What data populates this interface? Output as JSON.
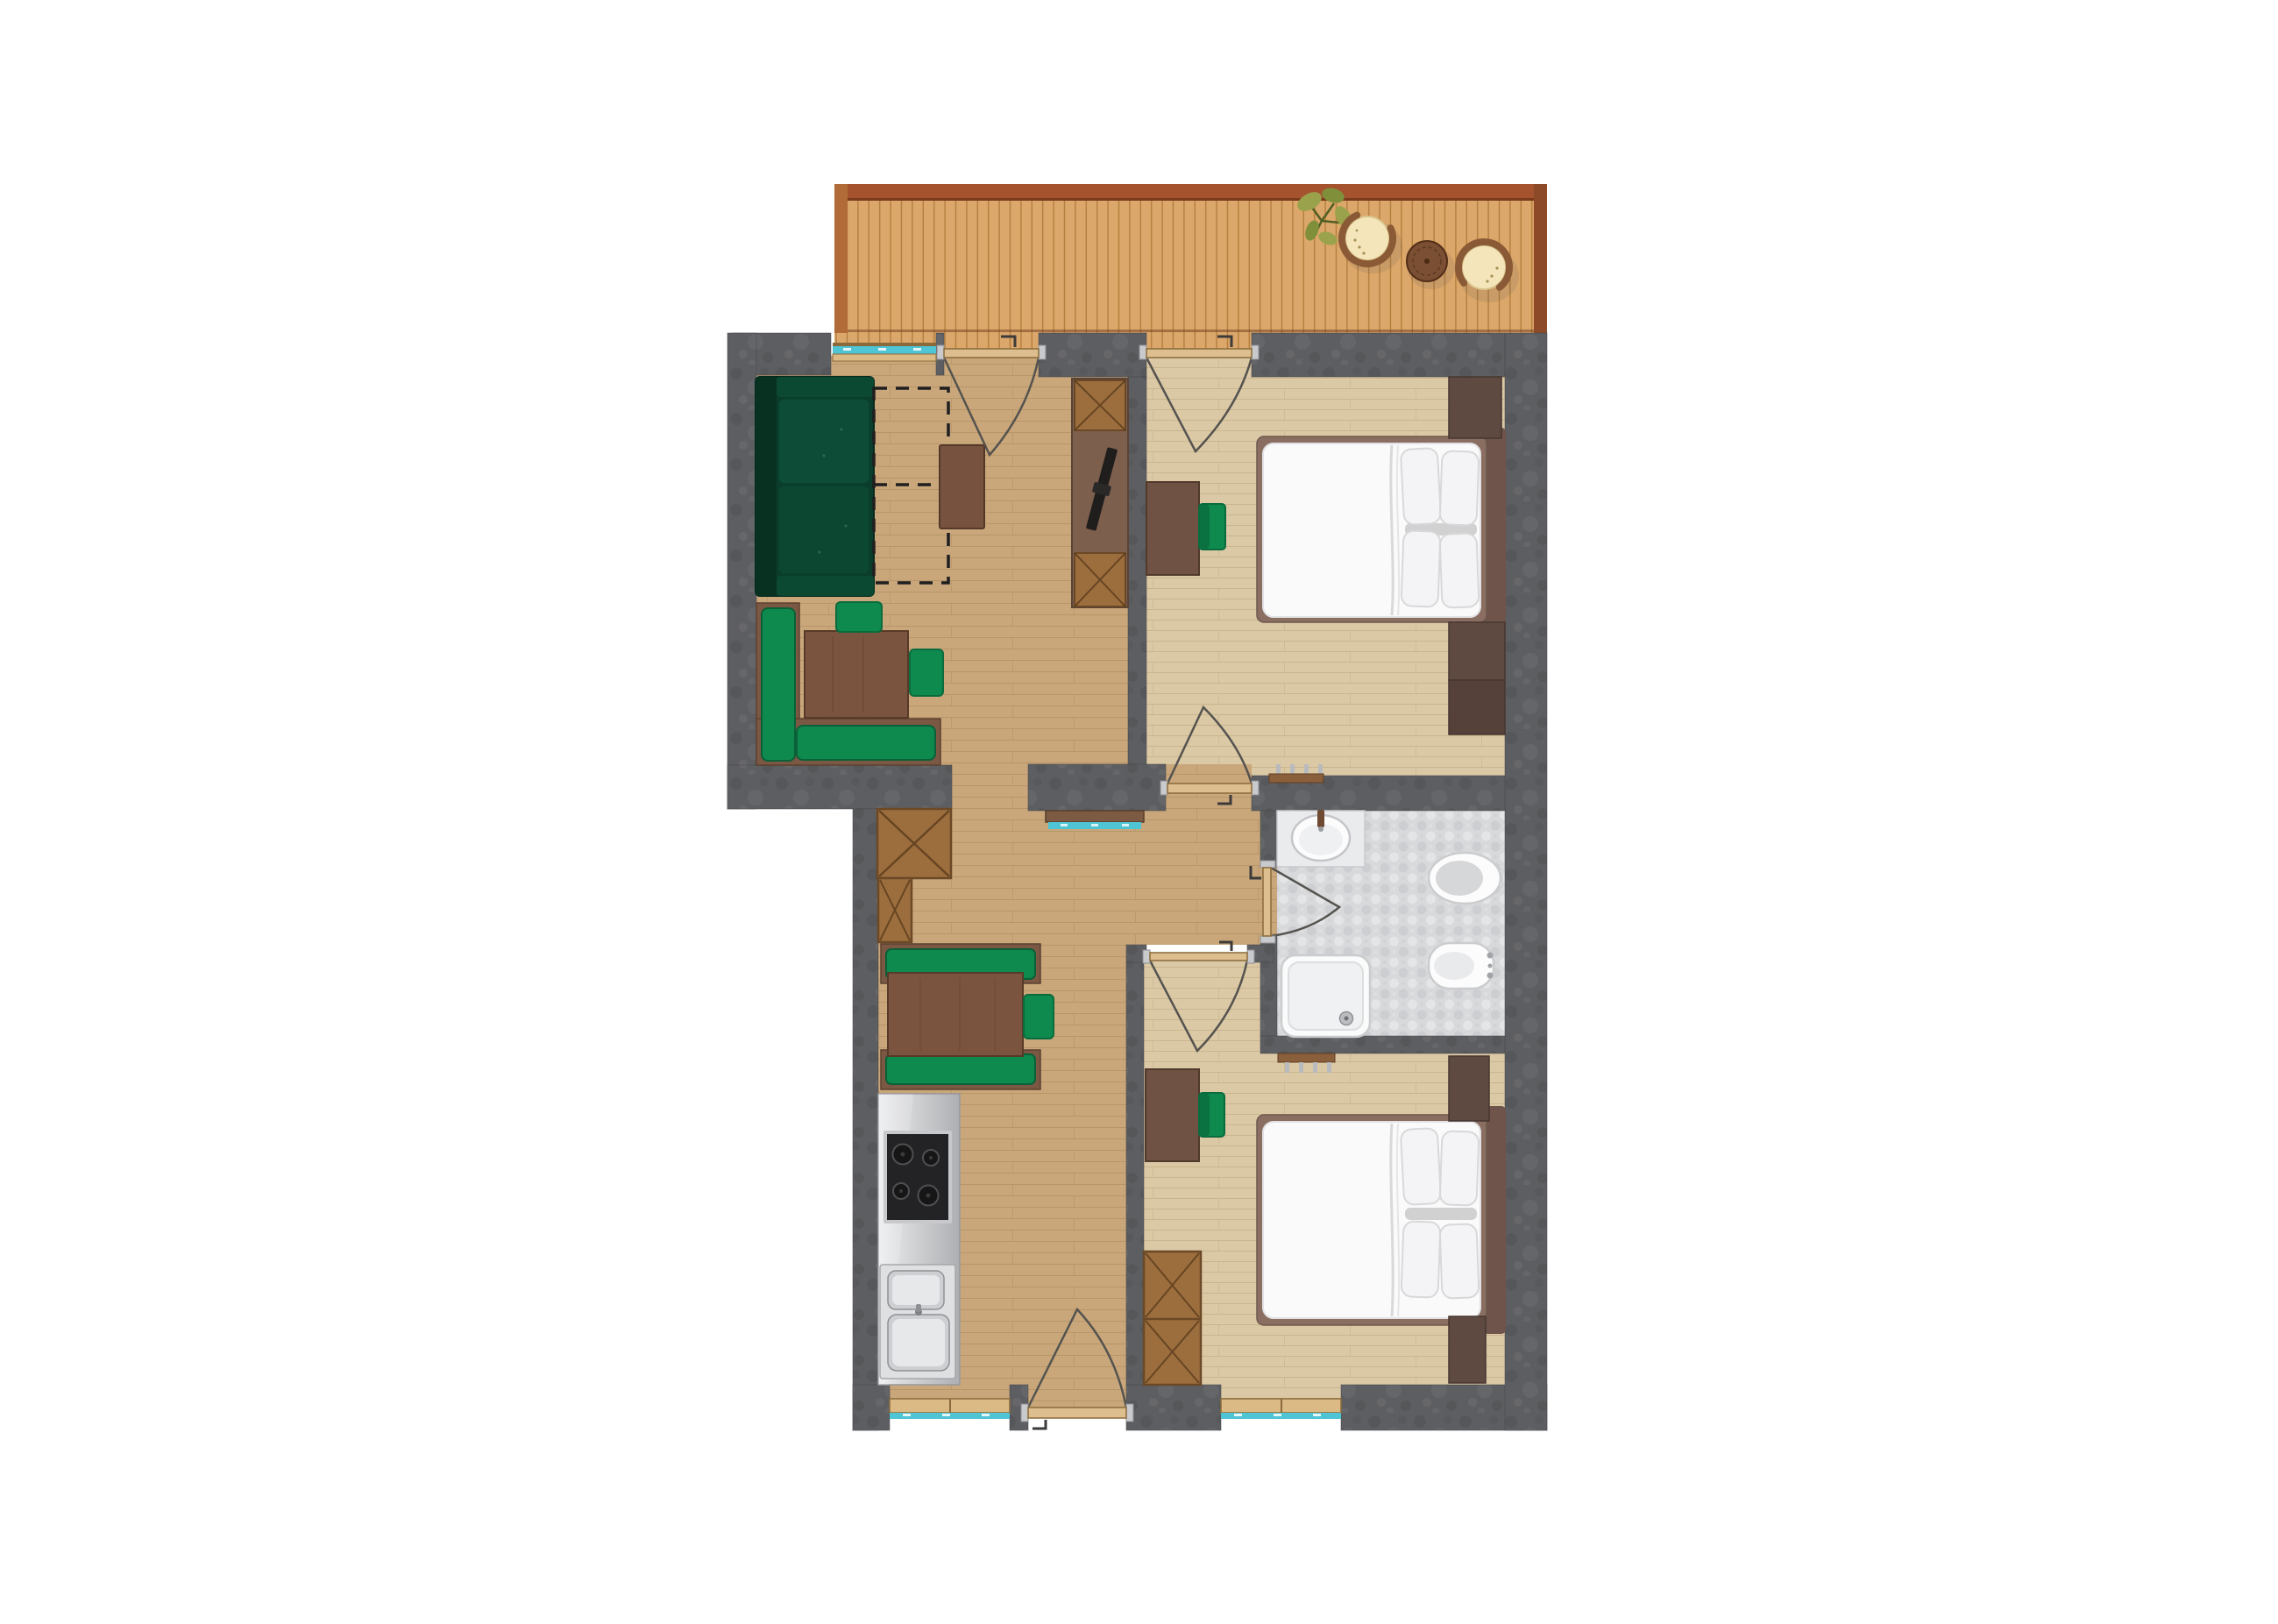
{
  "plan": {
    "type": "apartment-floor-plan",
    "rooms": [
      {
        "name": "terrace"
      },
      {
        "name": "living-dining-area"
      },
      {
        "name": "hallway"
      },
      {
        "name": "kitchen"
      },
      {
        "name": "bedroom-1"
      },
      {
        "name": "bathroom"
      },
      {
        "name": "bedroom-2"
      }
    ],
    "doors": [
      {
        "name": "balcony-door-living"
      },
      {
        "name": "balcony-door-bedroom-1"
      },
      {
        "name": "door-bedroom-1"
      },
      {
        "name": "door-bedroom-2"
      },
      {
        "name": "door-bathroom"
      },
      {
        "name": "entry-door"
      }
    ],
    "windows": [
      {
        "name": "living-room-window"
      },
      {
        "name": "kitchen-window"
      },
      {
        "name": "bedroom-2-window"
      }
    ],
    "furniture": {
      "terrace": [
        "plant",
        "rattan-lounge-chair",
        "round-side-table",
        "rattan-lounge-chair"
      ],
      "living_dining": [
        "corner-sofa",
        "sofa-bed-extension-outline",
        "coffee-table",
        "corner-bench",
        "dining-table",
        "dining-chair",
        "dining-chair",
        "tv-sideboard",
        "tv",
        "wardrobe-cabinet",
        "wardrobe-cabinet",
        "console-shelf"
      ],
      "kitchen": [
        "kitchen-counter",
        "cooktop",
        "double-sink",
        "booth-bench",
        "booth-bench",
        "dining-table",
        "dining-chair"
      ],
      "bedroom_1": [
        "desk",
        "desk-chair",
        "double-bed",
        "nightstand",
        "dresser",
        "radiator"
      ],
      "bathroom": [
        "vanity-sink",
        "toilet",
        "bidet",
        "shower"
      ],
      "bedroom_2": [
        "desk",
        "desk-chair",
        "wardrobe",
        "double-bed",
        "nightstand",
        "nightstand",
        "radiator"
      ]
    }
  },
  "colors": {
    "bg": "#ffffff",
    "wall": "#5d5e61",
    "wallEdge": "#45464a",
    "deck": "#dca76a",
    "deckLine": "#a5702f",
    "railTop": "#a4532e",
    "railLeft": "#b06b38",
    "railRight": "#8c4a28",
    "deckEdge": "#6b3c1e",
    "floorHall": "#c9a77a",
    "floorHallLine": "#a8885c",
    "floorBed": "#dbc9a6",
    "floorBedLine": "#bda87d",
    "tileBase": "#d8d9db",
    "tileDark": "#c9cacd",
    "tileLight": "#e4e5e7",
    "teal": "#4fc4d5",
    "sillTan": "#dcba86",
    "frameBrown": "#8a6a3a",
    "doorLeaf": "#ddbe8e",
    "arcStroke": "#55534f",
    "hingeGray": "#c9cacd",
    "handleDark": "#3c3b39",
    "furnBrown": "#7b5844",
    "tableBrown": "#7b5440",
    "tableEdge": "#573a28",
    "deskBrown": "#6f5243",
    "deskEdge": "#51392b",
    "cabWood": "#9c6e3e",
    "cabEdge": "#6b4826",
    "cabCross": "#5b3c1c",
    "tvBoard": "#7d5f4e",
    "tvBlack": "#201e1c",
    "sofaBase": "#0a3d2b",
    "sofaDark": "#083122",
    "sofaCushion": "#0d4c36",
    "sofaEdge": "#052a1d",
    "cushionGreen": "#0f8a4e",
    "cushionGreenDark": "#0a6038",
    "chairGreen": "#0e8a4e",
    "chairGreenDark": "#0a6b3d",
    "dashStroke": "#1f1f1f",
    "bedFrame": "#8a6e61",
    "headboard": "#6e544a",
    "mattress": "#fafafa",
    "mattressEdge": "#e2e2e4",
    "crease": "#d9d9db",
    "pillow": "#f4f4f6",
    "pillowEdge": "#d8d8da",
    "pillowShadow": "#aeaeb1",
    "nightstand": "#5f4a41",
    "nightstandDark": "#55413a",
    "nightstandEdge": "#463630",
    "fixtureWhite": "#fcfcfd",
    "fixtureEdge": "#cbccce",
    "fixtureInner": "#e9eaec",
    "seatGray": "#d6d7d9",
    "counterLight": "#ecedef",
    "counterDark": "#aeafb2",
    "steel": "#c8c9cc",
    "stoveBlack": "#232325",
    "burner": "#161617",
    "burnerRing": "#4f4f52",
    "sinkSteel": "#cdcfd2",
    "sinkInner": "#e7e8ea",
    "radiatorBar": "#8a5f3c",
    "radiatorEdge": "#5f3e22",
    "tick": "#b9babd",
    "consoleBrown": "#7d5a42",
    "plantGreen": "#9aa24b",
    "plantGreenDark": "#7f8f3a",
    "stem": "#4f5e23",
    "rattan": "#8a5a36",
    "cushionCream": "#f4e6ba",
    "cushionCreamEdge": "#d9c48e",
    "speckle": "#a89058",
    "tableRound": "#7b4f33",
    "tableRoundEdge": "#532f18",
    "shadow": "#4a4a4a"
  }
}
